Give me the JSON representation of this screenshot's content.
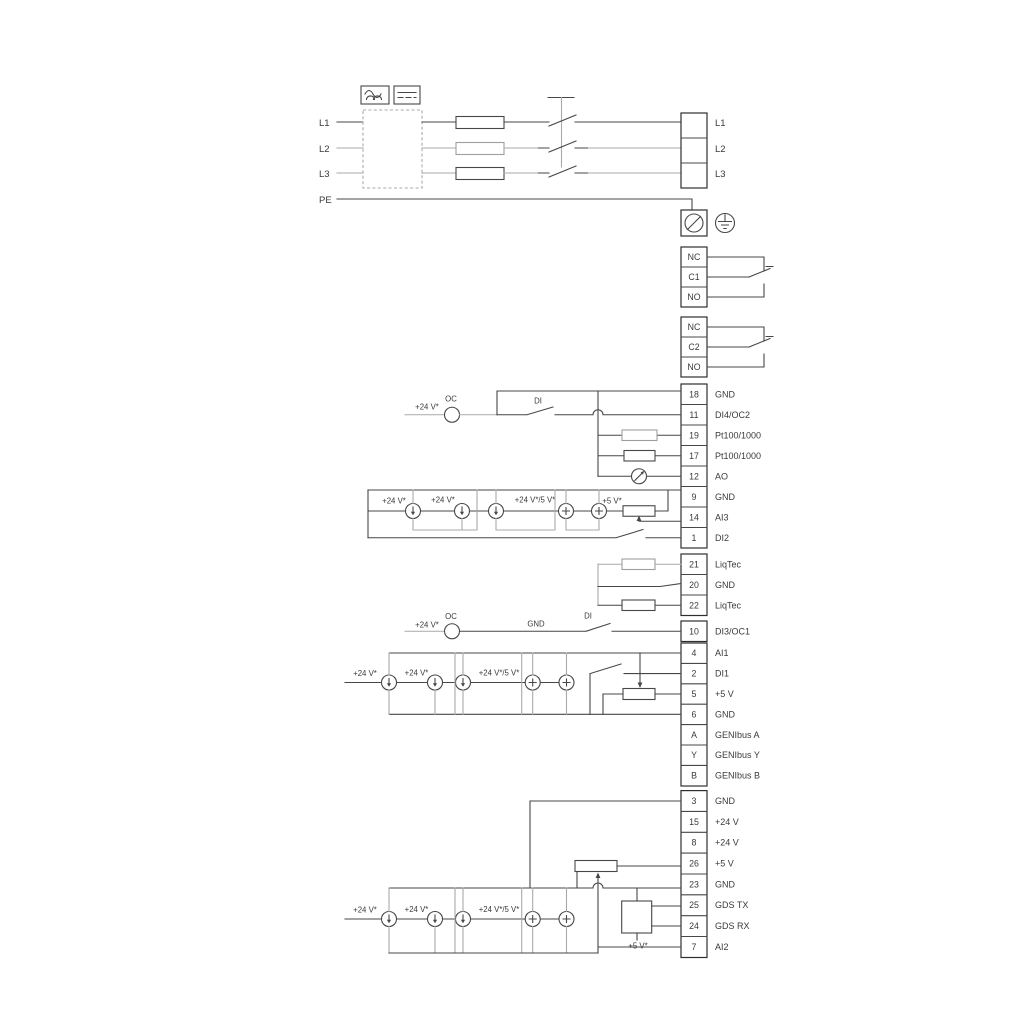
{
  "power": {
    "inputs": [
      "L1",
      "L2",
      "L3",
      "PE"
    ],
    "outputs": [
      "L1",
      "L2",
      "L3"
    ]
  },
  "relay1": {
    "nc": "NC",
    "c": "C1",
    "no": "NO"
  },
  "relay2": {
    "nc": "NC",
    "c": "C2",
    "no": "NO"
  },
  "io1": [
    {
      "num": "18",
      "label": "GND"
    },
    {
      "num": "11",
      "label": "DI4/OC2"
    },
    {
      "num": "19",
      "label": "Pt100/1000"
    },
    {
      "num": "17",
      "label": "Pt100/1000"
    },
    {
      "num": "12",
      "label": "AO"
    },
    {
      "num": "9",
      "label": "GND"
    },
    {
      "num": "14",
      "label": "AI3"
    },
    {
      "num": "1",
      "label": "DI2"
    }
  ],
  "liqtec": [
    {
      "num": "21",
      "label": "LiqTec"
    },
    {
      "num": "20",
      "label": "GND"
    },
    {
      "num": "22",
      "label": "LiqTec"
    }
  ],
  "di3row": {
    "num": "10",
    "label": "DI3/OC1"
  },
  "io2": [
    {
      "num": "4",
      "label": "AI1"
    },
    {
      "num": "2",
      "label": "DI1"
    },
    {
      "num": "5",
      "label": "+5 V"
    },
    {
      "num": "6",
      "label": "GND"
    },
    {
      "num": "A",
      "label": "GENIbus A"
    },
    {
      "num": "Y",
      "label": "GENIbus Y"
    },
    {
      "num": "B",
      "label": "GENIbus B"
    }
  ],
  "io3": [
    {
      "num": "3",
      "label": "GND"
    },
    {
      "num": "15",
      "label": "+24 V"
    },
    {
      "num": "8",
      "label": "+24 V"
    },
    {
      "num": "26",
      "label": "+5 V"
    },
    {
      "num": "23",
      "label": "GND"
    },
    {
      "num": "25",
      "label": "GDS TX"
    },
    {
      "num": "24",
      "label": "GDS RX"
    },
    {
      "num": "7",
      "label": "AI2"
    }
  ],
  "ann": {
    "di4": {
      "supply": "+24 V*",
      "oc": "OC",
      "di": "DI"
    },
    "di3": {
      "supply": "+24 V*",
      "oc": "OC",
      "gnd": "GND",
      "di": "DI"
    },
    "ai3": {
      "s1": "+24 V*",
      "s2": "+24 V*",
      "s3": "+24 V*/5 V*",
      "s4": "+5 V*"
    },
    "ai1": {
      "s1": "+24 V*",
      "s2": "+24 V*",
      "s3": "+24 V*/5 V*"
    },
    "ai2": {
      "s1": "+24 V*",
      "s2": "+24 V*",
      "s3": "+24 V*/5 V*",
      "s4": "+5 V*"
    }
  },
  "colors": {
    "wire_dark": "#474747",
    "wire_gray": "#a9a9a9",
    "text": "#3a3a3a",
    "background": "#ffffff"
  }
}
